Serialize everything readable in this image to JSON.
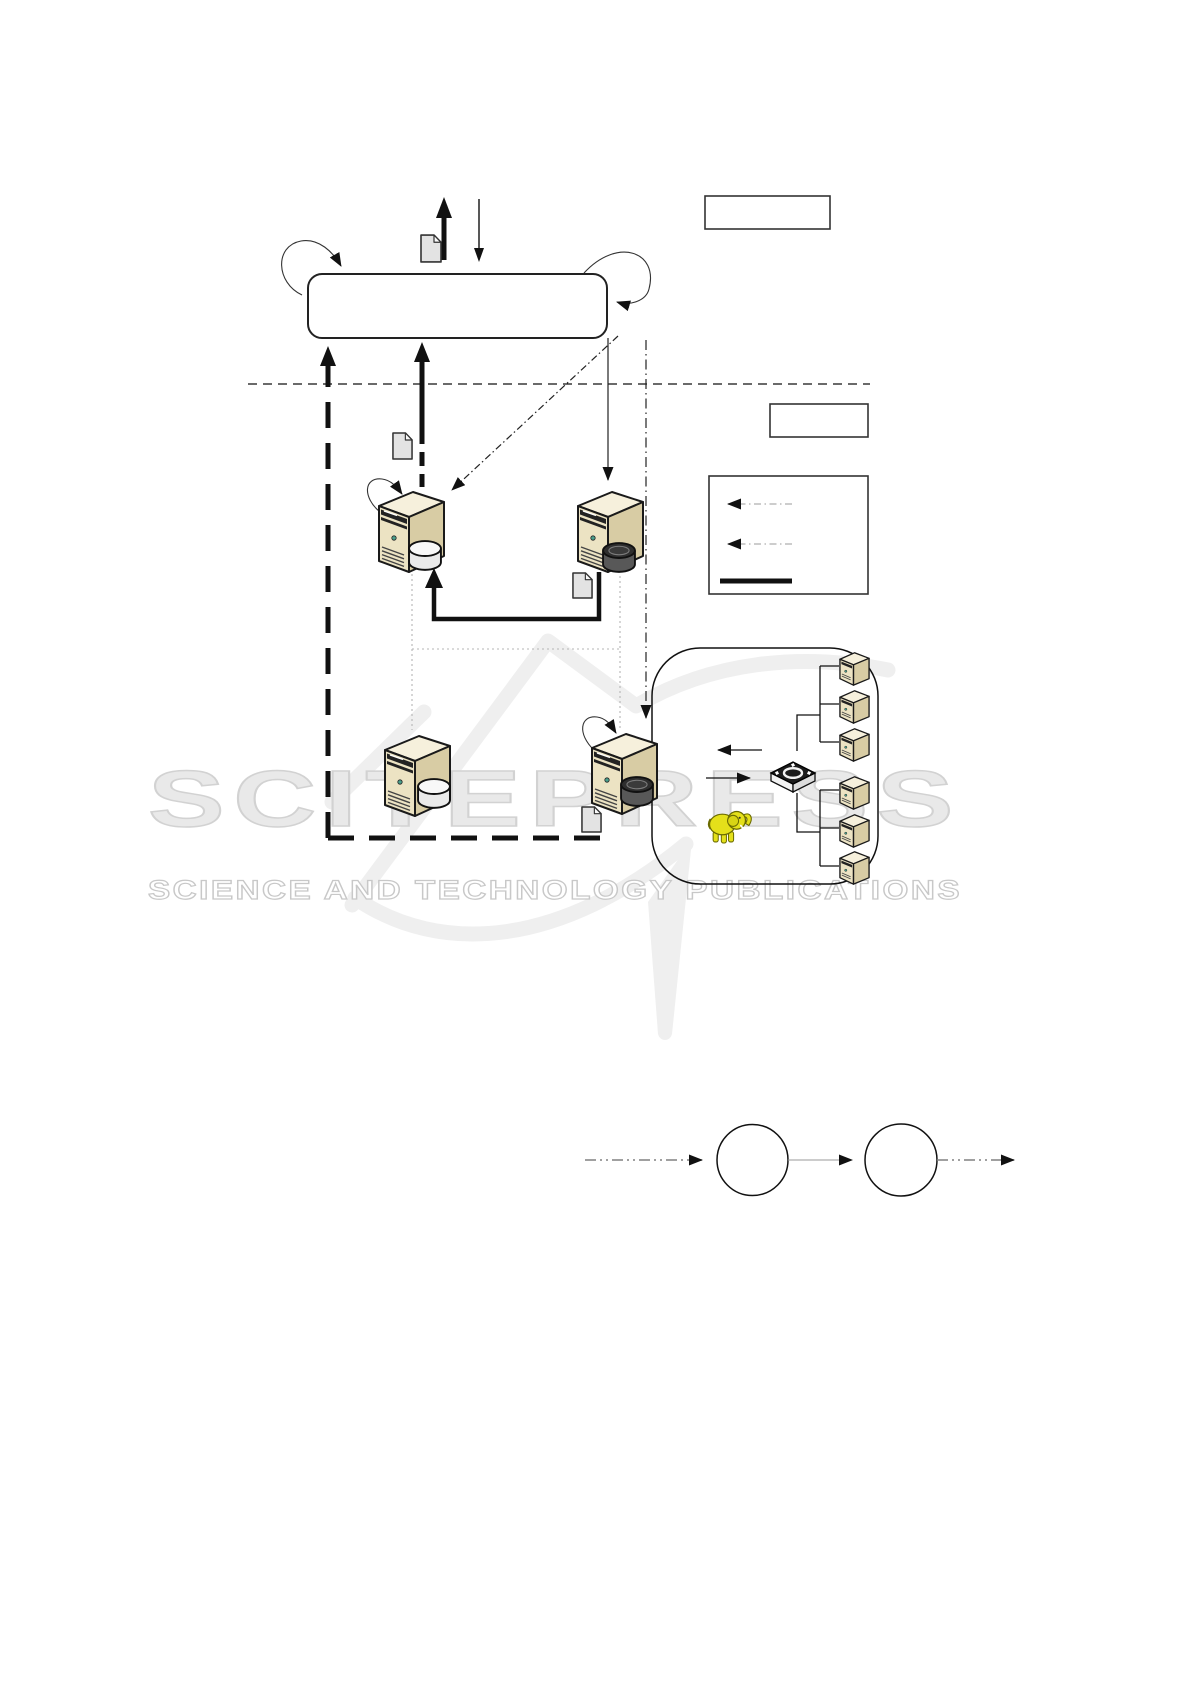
{
  "watermark": {
    "line1": "SCITEPRESS",
    "line2": "SCIENCE AND TECHNOLOGY PUBLICATIONS"
  },
  "figure": {
    "background_color": "#ffffff",
    "ink_color": "#1a1a1a",
    "watermark_text_color": "#e9e9e9",
    "watermark_outline_color": "#d2d2d2",
    "watermark_swoosh_color": "#efefef",
    "server_front_color": "#ece3c3",
    "server_top_color": "#f6f0dc",
    "server_side_color": "#d8cca4",
    "db_light_color": "#eaeaea",
    "db_dark_color": "#585858",
    "document_color": "#e3e3e3",
    "elephant_color": "#e4e01a",
    "legend_line_color": "#c6c6c6",
    "counts": {
      "upper_servers": 2,
      "lower_servers": 2,
      "worker_nodes": 6,
      "document_icons": 4,
      "flow_circles": 2,
      "empty_label_boxes": 2,
      "legend_rows": 3
    }
  }
}
